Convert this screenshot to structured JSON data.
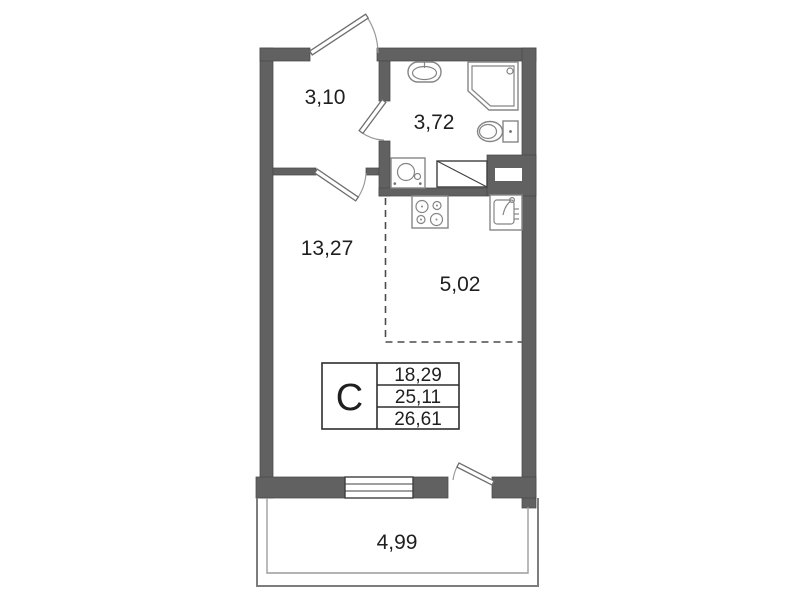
{
  "plan": {
    "title": "studio-apartment-floor-plan",
    "rooms": {
      "hallway": {
        "label": "3,10"
      },
      "bathroom": {
        "label": "3,72"
      },
      "living_room": {
        "label": "13,27"
      },
      "kitchen_zone": {
        "label": "5,02"
      },
      "balcony": {
        "label": "4,99"
      }
    },
    "stamp": {
      "letter": "С",
      "rows": [
        "18,29",
        "25,11",
        "26,61"
      ]
    },
    "icons": {
      "entry-door-icon": "door leaf with swing arc",
      "bathroom-door-icon": "door leaf with swing arc",
      "room-door-icon": "door leaf with swing arc",
      "balcony-door-icon": "door leaf with swing arc",
      "window-icon": "triple-line window in wall",
      "bathroom-sink-icon": "oval wash basin",
      "shower-icon": "shower cabin with chamfered corner",
      "toilet-icon": "toilet bowl with tank",
      "washing-machine-icon": "square with round door",
      "vent-shaft-icon": "rectangle with diagonal",
      "stove-icon": "four-burner cooktop",
      "kitchen-sink-icon": "square sink with faucet"
    },
    "colors": {
      "background": "#ffffff",
      "wall_fill": "#616161",
      "wall_outline": "#4a4a4a",
      "fixture_line": "#858585",
      "detail_line": "#3f3f3f",
      "balcony_line": "#7d7d7d",
      "text": "#1f1f1f"
    }
  }
}
